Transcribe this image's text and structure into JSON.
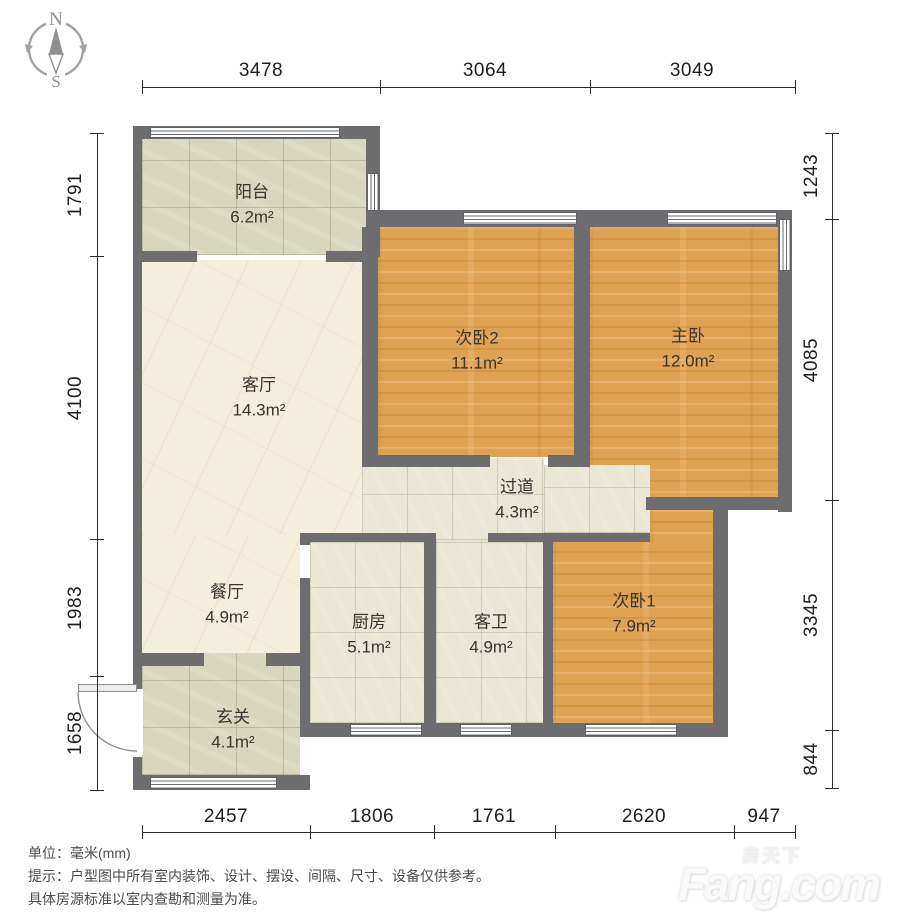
{
  "compass": {
    "north": "N",
    "south": "S"
  },
  "rooms": [
    {
      "name": "阳台",
      "area": "6.2m²"
    },
    {
      "name": "次卧2",
      "area": "11.1m²"
    },
    {
      "name": "主卧",
      "area": "12.0m²"
    },
    {
      "name": "客厅",
      "area": "14.3m²"
    },
    {
      "name": "过道",
      "area": "4.3m²"
    },
    {
      "name": "餐厅",
      "area": "4.9m²"
    },
    {
      "name": "厨房",
      "area": "5.1m²"
    },
    {
      "name": "客卫",
      "area": "4.9m²"
    },
    {
      "name": "次卧1",
      "area": "7.9m²"
    },
    {
      "name": "玄关",
      "area": "4.1m²"
    }
  ],
  "dimensions": {
    "top": [
      "3478",
      "3064",
      "3049"
    ],
    "bottom": [
      "2457",
      "1806",
      "1761",
      "2620",
      "947"
    ],
    "left": [
      "1791",
      "4100",
      "1983",
      "1658"
    ],
    "right": [
      "1243",
      "4085",
      "3345",
      "844"
    ]
  },
  "footer": {
    "unit_label": "单位：毫米(mm)",
    "tip_line1": "提示：户型图中所有室内装饰、设计、摆设、间隔、尺寸、设备仅供参考。",
    "tip_line2": "具体房源标准以室内查勘和测量为准。"
  },
  "watermark": {
    "brand_cn": "房天下",
    "brand_en": "Fang.com"
  },
  "colors": {
    "wall": "#6d6d70",
    "wood_floor": "#dfa152",
    "balcony_tile": "#d8d7bd",
    "hall_tile": "#e9e6d4",
    "marble_floor": "#f4eedd"
  }
}
